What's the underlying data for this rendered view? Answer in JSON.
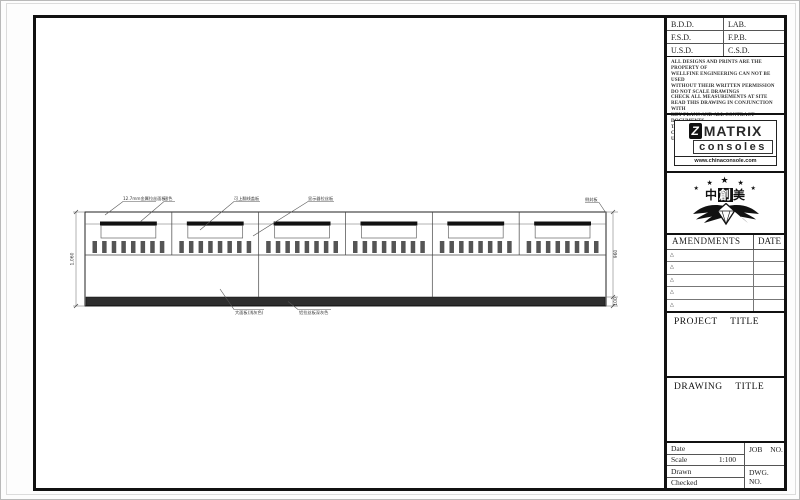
{
  "sheet": {
    "approval_rows": [
      [
        "B.D.D.",
        "LAB."
      ],
      [
        "F.S.D.",
        "F.P.B."
      ],
      [
        "U.S.D.",
        "C.S.D."
      ]
    ],
    "disclaimer": [
      "ALL DESIGNS AND PRINTS ARE THE PROPERTY OF",
      "WELLFINE ENGINEERING CAN NOT BE USED",
      "WITHOUT THEIR WRITTEN PERMISSION",
      "DO NOT SCALE DRAWINGS",
      "CHECK ALL MEASUREMENTS AT SITE",
      "READ THIS DRAWING IN CONJUNCTION WITH",
      "KEY PLANS AND ALL CONTRACT DOCUMENTS",
      "THIS DRAWING IS INVALID FOR CONSTRUCTION",
      "UNLESS EXPRESSLY CERTIFIED"
    ],
    "logo": {
      "brand": "MATRIX",
      "sub": "consoles",
      "icon_letter": "Z",
      "website": "www.chinaconsole.com"
    },
    "emblem": {
      "char1": "中",
      "char2": "創",
      "char3": "美",
      "star": "★"
    },
    "amendments": {
      "title": "AMENDMENTS",
      "date_label": "DATE",
      "row_mark": "△"
    },
    "project_title_label": "PROJECT TITLE",
    "drawing_title_label": "DRAWING TITLE",
    "info": {
      "date_label": "Date",
      "scale_label": "Scale",
      "scale_value": "1:100",
      "drawn_label": "Drawn",
      "checked_label": "Checked",
      "job_no": "JOB NO.",
      "dwg_no": "DWG. NO."
    }
  },
  "drawing": {
    "bay_count": 6,
    "slots_per_bay": 8,
    "dimensions": {
      "total_height": "1,060",
      "upper_height": "960",
      "plinth_height": "100"
    },
    "callouts": {
      "top1": "12.7mm金属拉丝面板",
      "top1b": "银色",
      "top2": "可上翻线盖板",
      "top3": "显示器拉丝板",
      "top4": "侧封板",
      "bottom1": "大面板(浅灰色)",
      "bottom2": "铝拉丝板深灰色"
    },
    "colors": {
      "line": "#1a1a1a",
      "plinth": "#2e2e2e",
      "slot": "#555555"
    }
  }
}
